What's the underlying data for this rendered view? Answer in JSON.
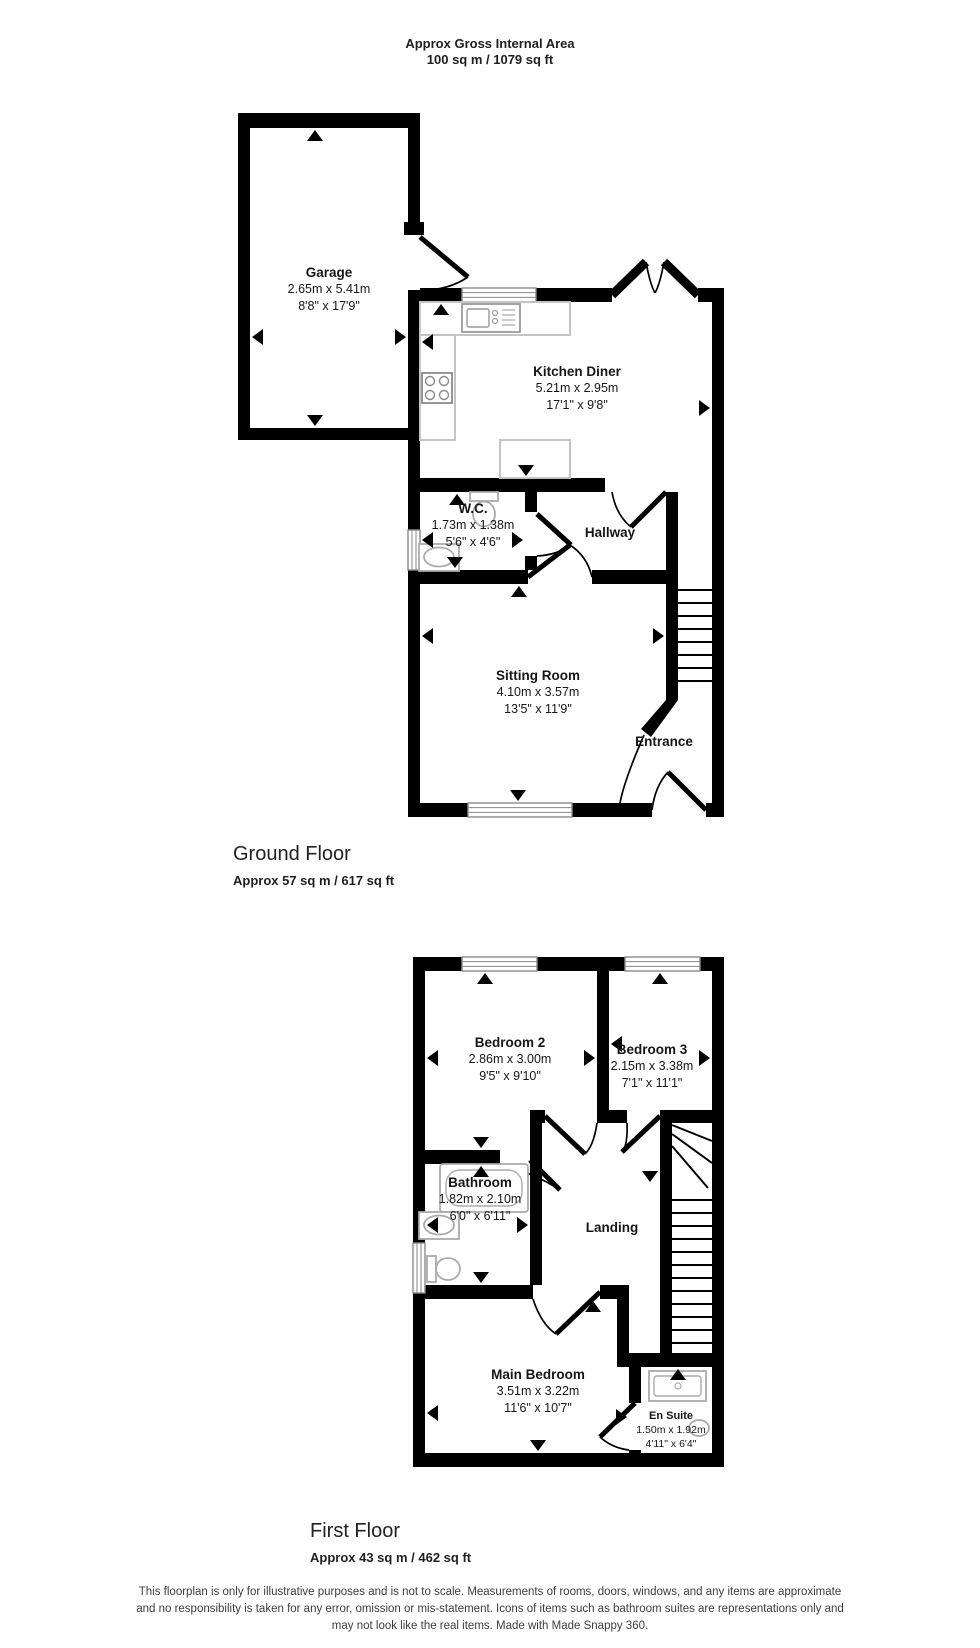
{
  "header": {
    "line1": "Approx Gross Internal Area",
    "line2": "100 sq m / 1079 sq ft"
  },
  "ground_floor": {
    "label": "Ground Floor",
    "area": "Approx 57 sq m / 617 sq ft",
    "rooms": [
      {
        "name": "Garage",
        "metric": "2.65m x 5.41m",
        "imperial": "8'8\" x 17'9\""
      },
      {
        "name": "Kitchen Diner",
        "metric": "5.21m x 2.95m",
        "imperial": "17'1\" x 9'8\""
      },
      {
        "name": "W.C.",
        "metric": "1.73m x 1.38m",
        "imperial": "5'6\" x 4'6\""
      },
      {
        "name": "Hallway"
      },
      {
        "name": "Sitting Room",
        "metric": "4.10m x 3.57m",
        "imperial": "13'5\" x 11'9\""
      },
      {
        "name": "Entrance"
      }
    ]
  },
  "first_floor": {
    "label": "First Floor",
    "area": "Approx 43 sq m / 462 sq ft",
    "rooms": [
      {
        "name": "Bedroom 2",
        "metric": "2.86m x 3.00m",
        "imperial": "9'5\" x 9'10\""
      },
      {
        "name": "Bedroom 3",
        "metric": "2.15m x 3.38m",
        "imperial": "7'1\" x 11'1\""
      },
      {
        "name": "Bathroom",
        "metric": "1.82m x 2.10m",
        "imperial": "6'0\" x 6'11\""
      },
      {
        "name": "Landing"
      },
      {
        "name": "Main Bedroom",
        "metric": "3.51m x 3.22m",
        "imperial": "11'6\" x 10'7\""
      },
      {
        "name": "En Suite",
        "metric": "1.50m x 1.92m",
        "imperial": "4'11\" x 6'4\""
      }
    ]
  },
  "disclaimer": {
    "line1": "This floorplan is only for illustrative purposes and is not to scale. Measurements of rooms, doors, windows, and any items are approximate",
    "line2": "and no responsibility is taken for any error, omission or mis-statement. Icons of items such as bathroom suites are representations only and",
    "line3": "may not look like the real items. Made with Made Snappy 360."
  },
  "colors": {
    "walls": "#000000",
    "fixtures": "#ababab",
    "windows": "#8a8a8a",
    "text": "#1a1a1a"
  },
  "icons": {
    "measurement_arrows": "black triangles marking measured wall spans",
    "ground_fixtures": [
      "kitchen-sink",
      "hob",
      "kitchen-counter",
      "wc-toilet",
      "wc-sink",
      "staircase"
    ],
    "first_fixtures": [
      "bathtub",
      "bathroom-sink",
      "toilet",
      "shower-tray",
      "ensuite-basin",
      "staircase"
    ]
  }
}
